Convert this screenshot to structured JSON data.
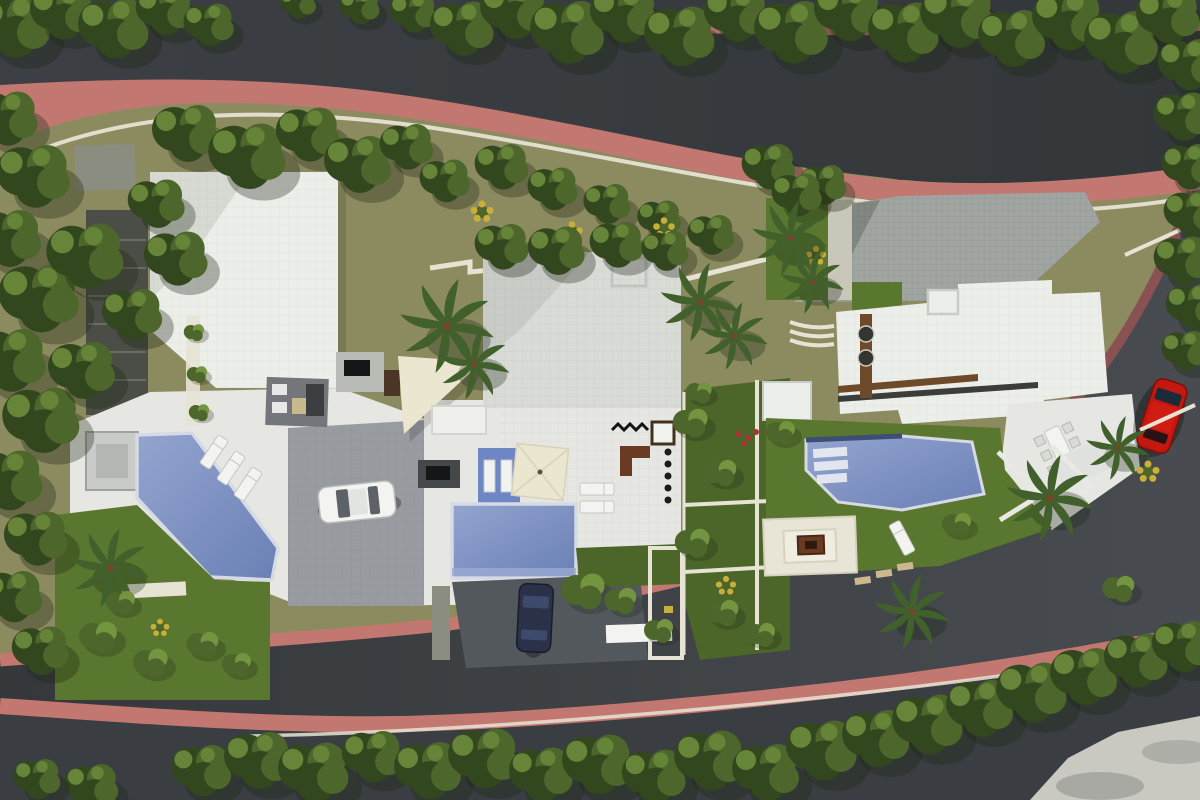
{
  "scene": {
    "type": "aerial-3d-architectural-site-render",
    "description": "Top-down render of three modern villas between two curved tree-lined streets",
    "villa_count": 3,
    "pools": 3,
    "cars": [
      {
        "color_name": "white",
        "location": "left villa driveway"
      },
      {
        "color_name": "dark navy",
        "location": "middle villa driveway"
      },
      {
        "color_name": "red",
        "location": "street parking at right villa"
      }
    ],
    "features": {
      "left_villa": [
        "white flat roof",
        "angled diagonal pool",
        "three sun loungers",
        "seating mat",
        "lawn with palm",
        "driveway"
      ],
      "middle_villa": [
        "large tiled roof",
        "rectangular pool",
        "blue mosaic wall with white doors",
        "cream parasol",
        "shade sail",
        "outdoor tv wall",
        "dark entry court"
      ],
      "right_villa": [
        "grey tiled courtyard",
        "white roof with wood pergola",
        "angled pool with steps",
        "sunken fire-pit lounge",
        "outdoor dining table",
        "parking bays"
      ]
    },
    "streets": [
      "upper curved road with pink sidewalks and hedges",
      "lower curved road wrapping right side"
    ]
  },
  "palette": {
    "road": "#3a3e42",
    "road2": "#474b4f",
    "sidewalk": "#c27870",
    "sidewalk_dark": "#8a5153",
    "curb": "#e7e3d4",
    "olive": "#8c8b60",
    "lawn": "#5a772f",
    "lawn2": "#4b6628",
    "tree_dark": "#33471f",
    "tree_mid": "#4c662c",
    "tree_light": "#74953f",
    "palm": "#41602b",
    "shadow": "#1c2413",
    "roof_white": "#eceeea",
    "roof_gray": "#d9dbd7",
    "terrace": "#e6e7e2",
    "courtyard": "#a0a5a1",
    "driveway": "#989ca0",
    "driveway_dark": "#53585c",
    "pool": "#7489bd",
    "pool_light": "#9aaad3",
    "wall_cream": "#ded9c6",
    "wood": "#6f4a2a",
    "fire": "#6b3a22",
    "car_white": "#f3f4f2",
    "car_dark": "#2b3148",
    "car_red": "#c2180f",
    "shade": "#ebe6d0",
    "blue_wall": "#6e86c4",
    "concrete": "#c9c9c2",
    "tv": "#141617",
    "flower": "#c9ae3a",
    "gravel": "#8b8d80",
    "path_dark": "#4b4e46",
    "rug": "#73767a",
    "wallgray": "#b9bbb7"
  }
}
